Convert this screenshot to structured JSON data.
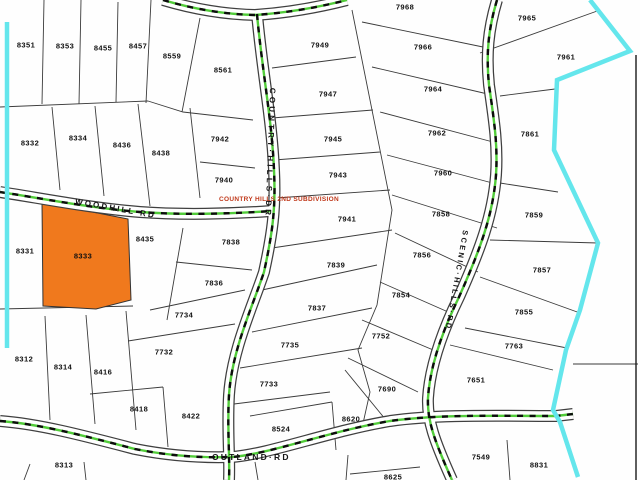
{
  "map": {
    "colors": {
      "highlight": "#F0791D",
      "boundary": "#64E6EC",
      "road_green": "#52CC3A",
      "subdivision_text": "#C0391B"
    },
    "selected_parcel": "8333",
    "subdivision_label": "COUNTRY HILLS 2ND SUBDIVISION",
    "roads": {
      "woodhill": {
        "label": "WOODHILL·RD"
      },
      "country_hills": {
        "label": "COUNTRY·HILLS·DR"
      },
      "scenic_hills": {
        "label": "SCENIC·HILLS·RD"
      },
      "outland": {
        "label": "OUTLAND·RD"
      }
    },
    "parcels": [
      {
        "label": "8351",
        "x": 26,
        "y": 45
      },
      {
        "label": "8353",
        "x": 65,
        "y": 46
      },
      {
        "label": "8455",
        "x": 103,
        "y": 48
      },
      {
        "label": "8457",
        "x": 138,
        "y": 46
      },
      {
        "label": "8559",
        "x": 172,
        "y": 56
      },
      {
        "label": "8561",
        "x": 223,
        "y": 70
      },
      {
        "label": "8332",
        "x": 30,
        "y": 143
      },
      {
        "label": "8334",
        "x": 78,
        "y": 138
      },
      {
        "label": "8436",
        "x": 122,
        "y": 145
      },
      {
        "label": "8438",
        "x": 161,
        "y": 153
      },
      {
        "label": "7942",
        "x": 220,
        "y": 139
      },
      {
        "label": "7940",
        "x": 224,
        "y": 180
      },
      {
        "label": "8331",
        "x": 25,
        "y": 251
      },
      {
        "label": "8333",
        "x": 83,
        "y": 256
      },
      {
        "label": "8435",
        "x": 145,
        "y": 239
      },
      {
        "label": "7838",
        "x": 231,
        "y": 242
      },
      {
        "label": "7836",
        "x": 214,
        "y": 283
      },
      {
        "label": "7734",
        "x": 184,
        "y": 315
      },
      {
        "label": "7732",
        "x": 164,
        "y": 352
      },
      {
        "label": "8312",
        "x": 24,
        "y": 359
      },
      {
        "label": "8314",
        "x": 63,
        "y": 367
      },
      {
        "label": "8416",
        "x": 103,
        "y": 372
      },
      {
        "label": "8418",
        "x": 139,
        "y": 409
      },
      {
        "label": "8422",
        "x": 191,
        "y": 416
      },
      {
        "label": "8313",
        "x": 64,
        "y": 465
      },
      {
        "label": "7949",
        "x": 320,
        "y": 45
      },
      {
        "label": "7947",
        "x": 328,
        "y": 94
      },
      {
        "label": "7945",
        "x": 333,
        "y": 139
      },
      {
        "label": "7943",
        "x": 338,
        "y": 175
      },
      {
        "label": "7941",
        "x": 347,
        "y": 219
      },
      {
        "label": "7839",
        "x": 336,
        "y": 265
      },
      {
        "label": "7837",
        "x": 317,
        "y": 308
      },
      {
        "label": "7735",
        "x": 290,
        "y": 345
      },
      {
        "label": "7733",
        "x": 269,
        "y": 384
      },
      {
        "label": "7968",
        "x": 405,
        "y": 7
      },
      {
        "label": "7966",
        "x": 423,
        "y": 47
      },
      {
        "label": "7964",
        "x": 433,
        "y": 89
      },
      {
        "label": "7962",
        "x": 437,
        "y": 133
      },
      {
        "label": "7960",
        "x": 443,
        "y": 173
      },
      {
        "label": "7858",
        "x": 441,
        "y": 214
      },
      {
        "label": "7856",
        "x": 422,
        "y": 255
      },
      {
        "label": "7854",
        "x": 401,
        "y": 295
      },
      {
        "label": "7752",
        "x": 381,
        "y": 336
      },
      {
        "label": "7690",
        "x": 387,
        "y": 389
      },
      {
        "label": "8620",
        "x": 351,
        "y": 419
      },
      {
        "label": "8524",
        "x": 281,
        "y": 429
      },
      {
        "label": "8625",
        "x": 393,
        "y": 477
      },
      {
        "label": "7965",
        "x": 527,
        "y": 18
      },
      {
        "label": "7961",
        "x": 566,
        "y": 57
      },
      {
        "label": "7861",
        "x": 530,
        "y": 134
      },
      {
        "label": "7859",
        "x": 534,
        "y": 215
      },
      {
        "label": "7857",
        "x": 542,
        "y": 270
      },
      {
        "label": "7855",
        "x": 524,
        "y": 312
      },
      {
        "label": "7763",
        "x": 514,
        "y": 346
      },
      {
        "label": "7651",
        "x": 476,
        "y": 380
      },
      {
        "label": "7549",
        "x": 481,
        "y": 457
      },
      {
        "label": "8831",
        "x": 539,
        "y": 465
      }
    ]
  }
}
